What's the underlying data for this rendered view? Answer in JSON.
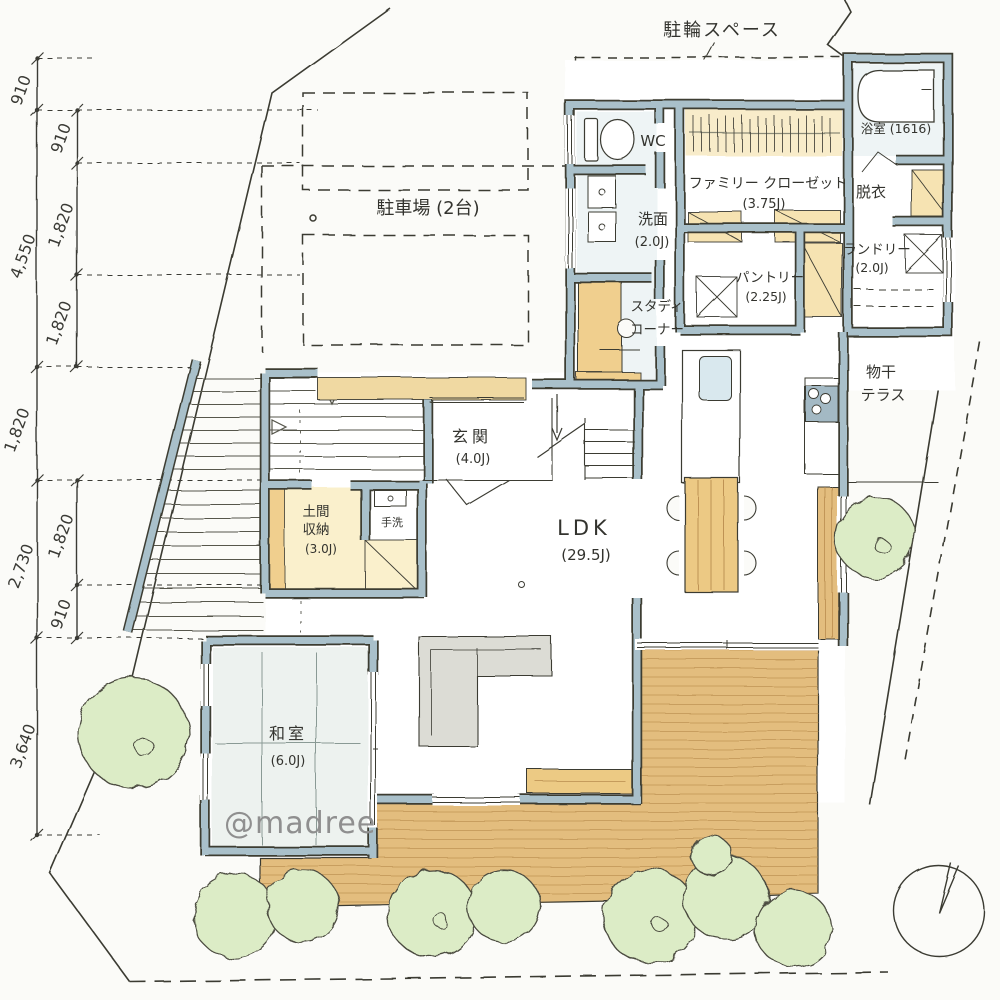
{
  "plan": {
    "watermark": "@madree",
    "site": {
      "bike_space_label": "駐輪スペース",
      "parking_label": "駐車場 (2台)"
    },
    "rooms": {
      "wc": {
        "name": "WC"
      },
      "senmen": {
        "name": "洗面",
        "size": "(2.0J)"
      },
      "study": {
        "line1": "スタディ",
        "line2": "コーナー"
      },
      "closet": {
        "name": "ファミリー クローゼット",
        "size": "(3.75J)"
      },
      "bath": {
        "name": "浴室 (1616)"
      },
      "datsui": {
        "name": "脱衣"
      },
      "laundry": {
        "name": "ランドリー",
        "size": "(2.0J)"
      },
      "pantry": {
        "name": "パントリー",
        "size": "(2.25J)"
      },
      "terrace": {
        "line1": "物干",
        "line2": "テラス"
      },
      "genkan": {
        "name": "玄関",
        "size": "(4.0J)"
      },
      "doma": {
        "line1": "土間",
        "line2": "収納",
        "size": "(3.0J)"
      },
      "tearai": {
        "name": "手洗"
      },
      "ldk": {
        "name": "LDK",
        "size": "(29.5J)"
      },
      "washitsu": {
        "name": "和室",
        "size": "(6.0J)"
      }
    },
    "dimensions": {
      "outer": [
        "910",
        "4,550",
        "1,820",
        "2,730",
        "3,640"
      ],
      "inner_upper": [
        "910",
        "1,820",
        "1,820"
      ],
      "inner_lower": [
        "1,820",
        "910"
      ]
    },
    "colors": {
      "paper": "#fbfbf8",
      "wall": "#a9c0ca",
      "ink": "#3a3a32",
      "wood_deck": "#e3bd7e",
      "cream": "#f6e7bf",
      "tan": "#f0cf8e",
      "green": "#dcecc6",
      "watermark_gray": "#8f8f8f"
    }
  }
}
